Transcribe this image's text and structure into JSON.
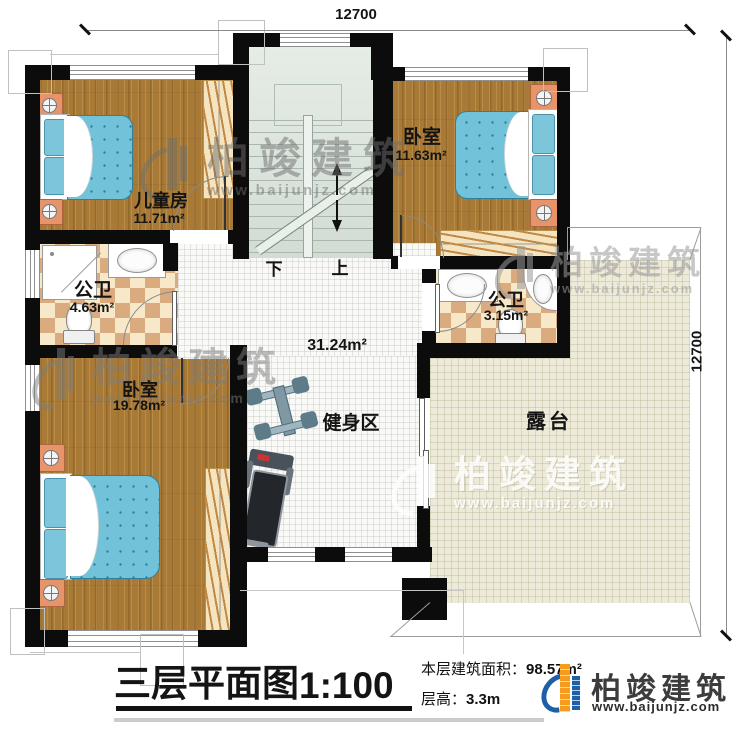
{
  "dimensions": {
    "top": "12700",
    "right": "12700"
  },
  "stairs": {
    "down_label": "下",
    "up_label": "上"
  },
  "rooms": {
    "kids": {
      "name": "儿童房",
      "area": "11.71m²"
    },
    "bedroom_top_right": {
      "name": "卧室",
      "area": "11.63m²"
    },
    "bath_left": {
      "name": "公卫",
      "area": "4.63m²"
    },
    "bath_right": {
      "name": "公卫",
      "area": "3.15m²"
    },
    "bedroom_bottom_left": {
      "name": "卧室",
      "area": "19.78m²"
    },
    "hall": {
      "area": "31.24m²"
    },
    "gym": {
      "name": "健身区"
    },
    "terrace": {
      "name": "露台"
    }
  },
  "title_block": {
    "plan_title": "三层平面图",
    "plan_scale": "1:100",
    "area_label": "本层建筑面积：",
    "area_value": "98.57m²",
    "floor_height_label": "层高：",
    "floor_height_value": "3.3m"
  },
  "brand": {
    "name": "柏竣建筑",
    "url": "www.baijunjz.com"
  },
  "watermark": {
    "name": "柏竣建筑",
    "url": "www.baijunjz.com"
  },
  "colors": {
    "wall": "#0c0c0c",
    "wood_floor": "#a87a36",
    "bath_tile_light": "#f6e8c8",
    "bath_tile_dark": "#d9ab7f",
    "stair": "#dce6df",
    "terrace": "#edeada",
    "mattress": "#72c3d9",
    "logo_orange": "#f59b1e",
    "logo_blue": "#1f5fa8"
  }
}
